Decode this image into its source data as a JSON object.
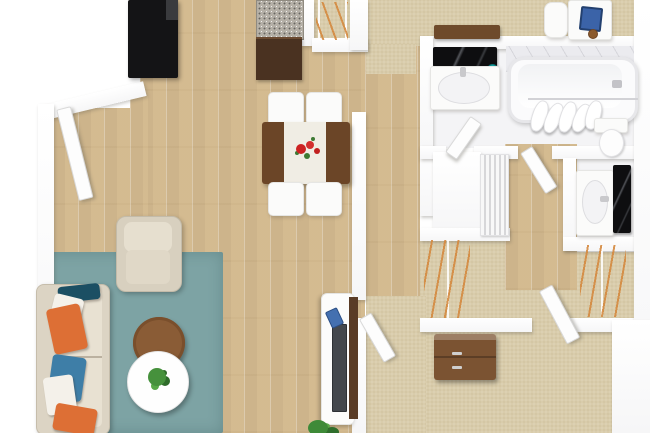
{
  "scene": {
    "type": "3d-floor-plan-top-view",
    "unit": "one-bedroom apartment with den, two bathrooms and walk-in closet",
    "rooms": [
      {
        "name": "kitchen",
        "floor": "wood",
        "items": [
          "black refrigerator",
          "granite counter with walnut cabinets"
        ]
      },
      {
        "name": "dining-area",
        "floor": "wood",
        "items": [
          "walnut dining table",
          "white table runner",
          "red flower centerpiece",
          "four white chairs"
        ]
      },
      {
        "name": "living-room",
        "floor": "wood",
        "items": [
          "beige sofa",
          "six throw pillows",
          "beige armchair",
          "teal area rug",
          "round wood coffee table",
          "round white coffee table",
          "potted plant",
          "white tv console",
          "flat tv",
          "blue soundbar",
          "floor plant",
          "entry door"
        ]
      },
      {
        "name": "linen-closet",
        "floor": "carpet",
        "items": [
          "wire shelving",
          "orange clothes hangers"
        ]
      },
      {
        "name": "office-nook",
        "floor": "carpet",
        "items": [
          "walnut sideboard desk",
          "white chair",
          "blue laptop",
          "white corner desk",
          "coffee cup"
        ]
      },
      {
        "name": "bathroom-1",
        "floor": "tile",
        "items": [
          "vanity sink",
          "black framed mirror",
          "teal accent jar",
          "bathtub",
          "shower curtain on rod",
          "toilet",
          "door"
        ]
      },
      {
        "name": "hallway",
        "floor": "wood",
        "items": [
          "louvered closet doors",
          "open doors"
        ]
      },
      {
        "name": "bathroom-2",
        "floor": "tile",
        "items": [
          "vanity sink",
          "black framed mirror",
          "door"
        ]
      },
      {
        "name": "walk-in-closet",
        "floor": "carpet",
        "items": [
          "left hanging rod with orange hangers",
          "right hanging rod with orange hangers"
        ]
      },
      {
        "name": "bedroom",
        "floor": "carpet",
        "items": [
          "walnut dresser with gray handles",
          "door"
        ]
      }
    ],
    "colors": {
      "wall": "#ffffff",
      "wood_floor": "#d7bf96",
      "carpet": "#d9ccab",
      "rug_teal": "#7da3a4",
      "sofa_beige": "#dcd4c4",
      "cushion_light": "#e8e1d2",
      "pillow_dark_teal": "#1b4f63",
      "pillow_orange": "#dd6f35",
      "pillow_blue": "#3e7ea7",
      "pillow_white": "#f4f1ea",
      "armchair_beige": "#d8d0bf",
      "coffee_table_wood": "#8a5c36",
      "coffee_table_white": "#fefefe",
      "plant_green": "#46913c",
      "fridge_black": "#141416",
      "granite_gray": "#b5b0a7",
      "cabinet_walnut": "#4a3221",
      "dining_table_wood": "#6b4527",
      "runner_white": "#f0ede4",
      "flower_red": "#cc2222",
      "console_panel_walnut": "#5a3c26",
      "tv_gray": "#44484d",
      "soundbar_blue": "#4470b0",
      "laptop_blue": "#3b63a8",
      "desk_wood": "#6e4a2b",
      "dresser_wood": "#7b5332",
      "hanger_orange": "#d4893f",
      "mirror_black": "#0e0e10",
      "accent_teal": "#13a3a3",
      "fixture_white": "#fbfbfa"
    }
  }
}
